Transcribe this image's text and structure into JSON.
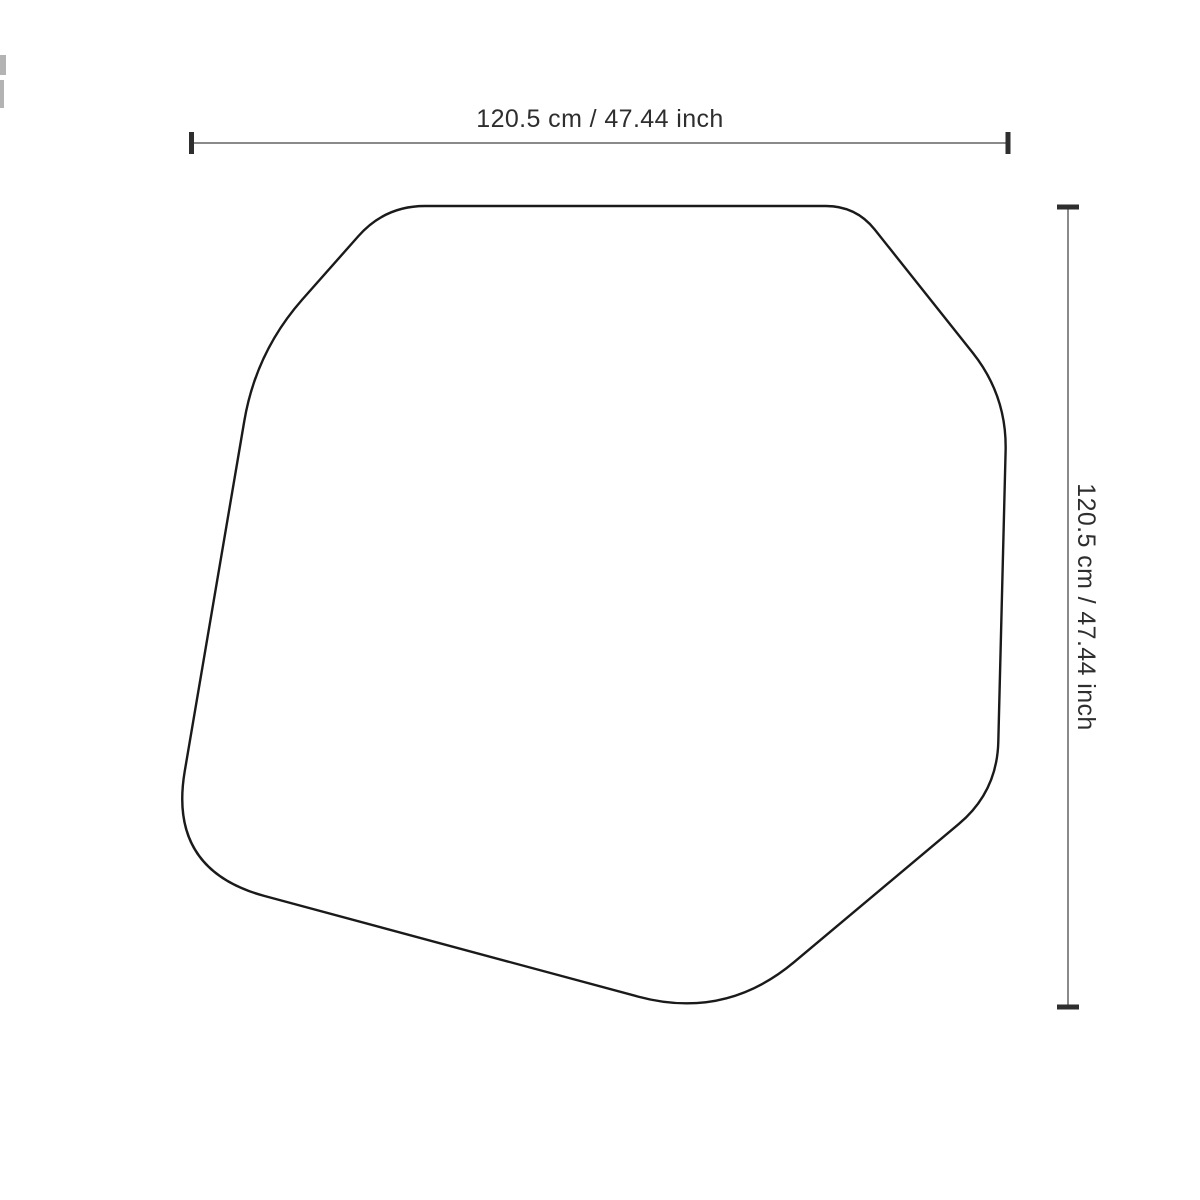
{
  "diagram": {
    "type": "product-dimension-drawing",
    "horizontal_dimension": {
      "label": "120.5 cm / 47.44 inch"
    },
    "vertical_dimension": {
      "label": "120.5 cm / 47.44 inch"
    }
  },
  "colors": {
    "background": "#ffffff",
    "outline": "#1a1a1a",
    "shape_fill": "#ffffff",
    "dimension_line": "#8a8a8a",
    "tick": "#2e2e2e",
    "label_text": "#2e2e2e",
    "edge_artifact": "#b3b3b3"
  },
  "shape": {
    "name": "irregular-tabletop-outline",
    "vertices": [
      [
        385,
        206
      ],
      [
        856,
        206
      ],
      [
        1007,
        396
      ],
      [
        997,
        792
      ],
      [
        725,
        1020
      ],
      [
        168,
        870
      ],
      [
        256,
        352
      ]
    ],
    "corner_trim": [
      40,
      30,
      55,
      50,
      90,
      100,
      70
    ],
    "stroke_width": 2.4
  }
}
